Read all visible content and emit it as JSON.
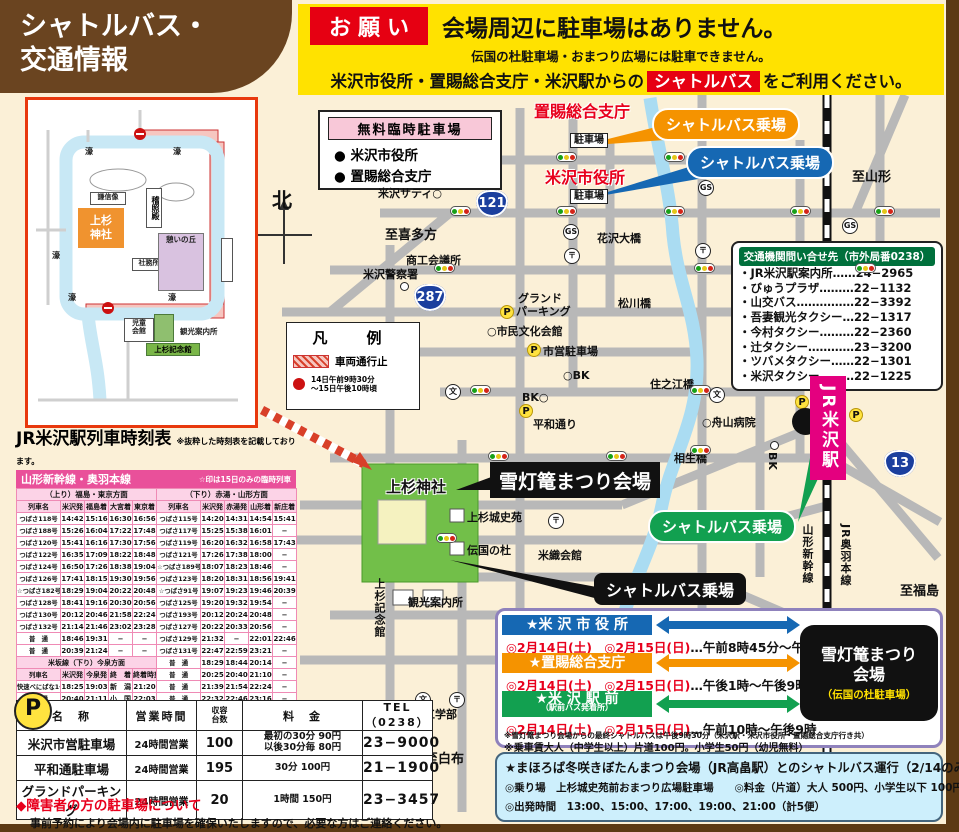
{
  "header": {
    "title_line1": "シャトルバス・",
    "title_line2": "交通情報",
    "request_badge": "お願い",
    "main_notice": "会場周辺に駐車場はありません。",
    "sub_notice": "伝国の杜駐車場・おまつり広場には駐車できません。",
    "line3_pre": "米沢市役所・置賜総合支庁・米沢駅からの",
    "line3_badge": "シャトルバス",
    "line3_post": "をご利用ください。"
  },
  "free_parking_box": {
    "title": "無料臨時駐車場",
    "items": [
      "● 米沢市役所",
      "● 置賜総合支庁"
    ]
  },
  "legend": {
    "title": "凡　例",
    "no_entry_label": "車両通行止",
    "note_line1": "14日午前9時30分",
    "note_line2": "〜15日午後10時頃"
  },
  "compass": "北",
  "inset": {
    "labels": {
      "moat": "濠",
      "shrine": "上杉神社",
      "keisho": "稽照殿",
      "statue": "謙信像",
      "office": "社務所",
      "hill": "憩いの丘",
      "child": "児童会館",
      "memorial": "上杉記念館",
      "info": "観光案内所"
    }
  },
  "map": {
    "bubbles": {
      "orange": "シャトルバス乗場",
      "blue": "シャトルバス乗場",
      "green": "シャトルバス乗場",
      "black": "シャトルバス乗場"
    },
    "venue_callout": "雪灯篭まつり会場",
    "station": "JR米沢駅",
    "badges": [
      {
        "n": "121",
        "x": 476,
        "y": 190
      },
      {
        "n": "287",
        "x": 414,
        "y": 284
      },
      {
        "n": "13",
        "x": 884,
        "y": 450
      }
    ],
    "labels": [
      {
        "t": "置賜総合支庁",
        "x": 534,
        "y": 98,
        "c": "redbig"
      },
      {
        "t": "米沢市役所",
        "x": 545,
        "y": 164,
        "c": "redbig"
      },
      {
        "t": "駐車場",
        "x": 570,
        "y": 133,
        "c": "pbox"
      },
      {
        "t": "駐車場",
        "x": 570,
        "y": 189,
        "c": "pbox"
      },
      {
        "t": "米沢サティ○",
        "x": 378,
        "y": 185,
        "c": "plain"
      },
      {
        "t": "至喜多方",
        "x": 385,
        "y": 224,
        "c": "dir"
      },
      {
        "t": "至山形",
        "x": 852,
        "y": 166,
        "c": "dir"
      },
      {
        "t": "商工会議所",
        "x": 406,
        "y": 252,
        "c": "plain"
      },
      {
        "t": "米沢警察署",
        "x": 363,
        "y": 266,
        "c": "plain"
      },
      {
        "t": "花沢大橋",
        "x": 597,
        "y": 230,
        "c": "plain"
      },
      {
        "t": "松川橋",
        "x": 618,
        "y": 295,
        "c": "plain"
      },
      {
        "t": "グランド",
        "x": 518,
        "y": 290,
        "c": "plain"
      },
      {
        "t": "パーキング",
        "x": 516,
        "y": 303,
        "c": "plain"
      },
      {
        "t": "○市民文化会館",
        "x": 487,
        "y": 323,
        "c": "plain"
      },
      {
        "t": "市営駐車場",
        "x": 543,
        "y": 343,
        "c": "plain"
      },
      {
        "t": "○BK",
        "x": 563,
        "y": 369,
        "c": "plain"
      },
      {
        "t": "BK○",
        "x": 522,
        "y": 391,
        "c": "plain"
      },
      {
        "t": "平和通り",
        "x": 533,
        "y": 416,
        "c": "plain"
      },
      {
        "t": "住之江橋",
        "x": 650,
        "y": 376,
        "c": "plain"
      },
      {
        "t": "○舟山病院",
        "x": 702,
        "y": 414,
        "c": "plain"
      },
      {
        "t": "相生橋",
        "x": 674,
        "y": 450,
        "c": "plain"
      },
      {
        "t": "米織会館",
        "x": 538,
        "y": 547,
        "c": "plain"
      },
      {
        "t": "観光案内所",
        "x": 408,
        "y": 594,
        "c": "plain"
      },
      {
        "t": "山大工学部",
        "x": 402,
        "y": 706,
        "c": "plain"
      },
      {
        "t": "至白布",
        "x": 425,
        "y": 748,
        "c": "dir"
      },
      {
        "t": "至福島",
        "x": 900,
        "y": 580,
        "c": "dir"
      },
      {
        "t": "上杉城史苑",
        "x": 467,
        "y": 509,
        "c": "plain"
      },
      {
        "t": "伝国の杜",
        "x": 467,
        "y": 542,
        "c": "plain"
      },
      {
        "t": "上杉神社",
        "x": 386,
        "y": 476,
        "c": "shrine-l"
      },
      {
        "t": "山形新幹線",
        "x": 799,
        "y": 524,
        "c": "vert"
      },
      {
        "t": "JR奥羽本線",
        "x": 837,
        "y": 524,
        "c": "vert"
      },
      {
        "t": "上杉記念館",
        "x": 371,
        "y": 578,
        "c": "vert"
      },
      {
        "t": "BK",
        "x": 766,
        "y": 452,
        "c": "vert"
      },
      {
        "t": "北",
        "x": 272,
        "y": 184,
        "c": "north-l"
      }
    ],
    "icons": [
      {
        "k": "traffic",
        "x": 556,
        "y": 152
      },
      {
        "k": "traffic",
        "x": 664,
        "y": 152
      },
      {
        "k": "traffic",
        "x": 450,
        "y": 206
      },
      {
        "k": "traffic",
        "x": 556,
        "y": 206
      },
      {
        "k": "traffic",
        "x": 664,
        "y": 206
      },
      {
        "k": "traffic",
        "x": 790,
        "y": 206
      },
      {
        "k": "traffic",
        "x": 874,
        "y": 206
      },
      {
        "k": "traffic",
        "x": 434,
        "y": 263
      },
      {
        "k": "traffic",
        "x": 694,
        "y": 263
      },
      {
        "k": "traffic",
        "x": 855,
        "y": 263
      },
      {
        "k": "traffic",
        "x": 470,
        "y": 385
      },
      {
        "k": "traffic",
        "x": 690,
        "y": 385
      },
      {
        "k": "traffic",
        "x": 488,
        "y": 451
      },
      {
        "k": "traffic",
        "x": 606,
        "y": 451
      },
      {
        "k": "traffic",
        "x": 690,
        "y": 445
      },
      {
        "k": "traffic",
        "x": 436,
        "y": 533
      },
      {
        "k": "traffic",
        "x": 700,
        "y": 533
      },
      {
        "k": "gs",
        "t": "GS",
        "x": 563,
        "y": 224
      },
      {
        "k": "gs",
        "t": "GS",
        "x": 698,
        "y": 180
      },
      {
        "k": "gs",
        "t": "GS",
        "x": 842,
        "y": 218
      },
      {
        "k": "post",
        "t": "〒",
        "x": 564,
        "y": 248
      },
      {
        "k": "post",
        "t": "〒",
        "x": 695,
        "y": 243
      },
      {
        "k": "post",
        "t": "〒",
        "x": 548,
        "y": 513
      },
      {
        "k": "post",
        "t": "〒",
        "x": 449,
        "y": 692
      },
      {
        "k": "school",
        "t": "文",
        "x": 445,
        "y": 384
      },
      {
        "k": "school",
        "t": "文",
        "x": 709,
        "y": 387
      },
      {
        "k": "school",
        "t": "文",
        "x": 415,
        "y": 692
      },
      {
        "k": "circ",
        "x": 400,
        "y": 282
      },
      {
        "k": "circ",
        "x": 770,
        "y": 441
      },
      {
        "k": "p",
        "t": "P",
        "x": 500,
        "y": 305
      },
      {
        "k": "p",
        "t": "P",
        "x": 527,
        "y": 343
      },
      {
        "k": "p",
        "t": "P",
        "x": 519,
        "y": 404
      },
      {
        "k": "p",
        "t": "P",
        "x": 795,
        "y": 395
      },
      {
        "k": "p",
        "t": "P",
        "x": 849,
        "y": 408
      }
    ]
  },
  "contact_box": {
    "title": "交通機関問い合せ先（市外局番0238）",
    "entries": [
      {
        "name": "・JR米沢駅案内所",
        "dots": "……",
        "tel": "24−2965"
      },
      {
        "name": "・びゅうプラザ",
        "dots": "………",
        "tel": "22−1132"
      },
      {
        "name": "・山交バス",
        "dots": "……………",
        "tel": "22−3392"
      },
      {
        "name": "・吾妻観光タクシー",
        "dots": "…",
        "tel": "22−1317"
      },
      {
        "name": "・今村タクシー",
        "dots": "………",
        "tel": "22−2360"
      },
      {
        "name": "・辻タクシー",
        "dots": "…………",
        "tel": "23−3200"
      },
      {
        "name": "・ツバメタクシー",
        "dots": "……",
        "tel": "22−1301"
      },
      {
        "name": "・米沢タクシー",
        "dots": "………",
        "tel": "22−1225"
      }
    ]
  },
  "timetable": {
    "title": "JR米沢駅列車時刻表",
    "title_note": "※抜粋した時刻表を記載しております。",
    "line_name": "山形新幹線・奥羽本線",
    "line_note": "☆印は15日のみの臨時列車",
    "up": {
      "direction": "（上り）福島・東京方面",
      "cols": [
        "列車名",
        "米沢発",
        "福島着",
        "大宮着",
        "東京着"
      ],
      "rows": [
        [
          "つばさ118号",
          "14:42",
          "15:16",
          "16:30",
          "16:56"
        ],
        [
          "つばさ188号",
          "15:26",
          "16:04",
          "17:22",
          "17:48"
        ],
        [
          "つばさ120号",
          "15:41",
          "16:16",
          "17:30",
          "17:56"
        ],
        [
          "つばさ122号",
          "16:35",
          "17:09",
          "18:22",
          "18:48"
        ],
        [
          "つばさ124号",
          "16:50",
          "17:26",
          "18:38",
          "19:04"
        ],
        [
          "つばさ126号",
          "17:41",
          "18:15",
          "19:30",
          "19:56"
        ],
        [
          "☆つばさ182号",
          "18:29",
          "19:04",
          "20:22",
          "20:48"
        ],
        [
          "つばさ128号",
          "18:41",
          "19:16",
          "20:30",
          "20:56"
        ],
        [
          "つばさ130号",
          "20:12",
          "20:46",
          "21:58",
          "22:24"
        ],
        [
          "つばさ132号",
          "21:14",
          "21:46",
          "23:02",
          "23:28"
        ],
        [
          "普　通",
          "18:46",
          "19:31",
          "−",
          "−"
        ],
        [
          "普　通",
          "20:39",
          "21:24",
          "−",
          "−"
        ]
      ]
    },
    "down": {
      "direction": "（下り）赤湯・山形方面",
      "cols": [
        "列車名",
        "米沢発",
        "赤湯発",
        "山形着",
        "新庄着"
      ],
      "rows": [
        [
          "つばさ115号",
          "14:20",
          "14:31",
          "14:54",
          "15:41"
        ],
        [
          "つばさ117号",
          "15:25",
          "15:38",
          "16:01",
          "−"
        ],
        [
          "つばさ119号",
          "16:20",
          "16:32",
          "16:58",
          "17:43"
        ],
        [
          "つばさ121号",
          "17:26",
          "17:38",
          "18:00",
          "−"
        ],
        [
          "☆つばさ189号",
          "18:07",
          "18:23",
          "18:46",
          "−"
        ],
        [
          "つばさ123号",
          "18:20",
          "18:31",
          "18:56",
          "19:41"
        ],
        [
          "☆つばさ91号",
          "19:07",
          "19:23",
          "19:46",
          "20:39"
        ],
        [
          "つばさ125号",
          "19:20",
          "19:32",
          "19:54",
          "−"
        ],
        [
          "つばさ193号",
          "20:12",
          "20:24",
          "20:48",
          "−"
        ],
        [
          "つばさ127号",
          "20:22",
          "20:33",
          "20:56",
          "−"
        ],
        [
          "つばさ129号",
          "21:32",
          "−",
          "22:01",
          "22:46"
        ],
        [
          "つばさ131号",
          "22:47",
          "22:59",
          "23:21",
          "−"
        ],
        [
          "普　通",
          "18:29",
          "18:44",
          "20:14",
          "−"
        ],
        [
          "普　通",
          "20:25",
          "20:40",
          "21:10",
          "−"
        ],
        [
          "普　通",
          "21:39",
          "21:54",
          "22:24",
          "−"
        ],
        [
          "普　通",
          "22:32",
          "22:46",
          "23:16",
          "−"
        ]
      ]
    },
    "yonesaka": {
      "header": "米坂線（下り）今泉方面",
      "cols": [
        "列車名",
        "米沢発",
        "今泉発",
        "終　着",
        "終着時刻"
      ],
      "rows": [
        [
          "快速べにばな1号",
          "18:25",
          "19:03",
          "新　潟",
          "21:20"
        ],
        [
          "普　通",
          "20:40",
          "21:11",
          "小　国",
          "22:03"
        ]
      ]
    }
  },
  "parking_table": {
    "p_badge": "P",
    "cols": [
      "名　称",
      "営業時間",
      "収容\n台数",
      "料　金",
      "TEL（0238）"
    ],
    "rows": [
      [
        "米沢市営駐車場",
        "24時間営業",
        "100",
        "最初の30分 90円\n以後30分毎 80円",
        "23−9000"
      ],
      [
        "平和通駐車場",
        "24時間営業",
        "195",
        "30分 100円",
        "21−1900"
      ],
      [
        "グランドパーキング",
        "24時間営業",
        "20",
        "1時間 150円",
        "23−3457"
      ]
    ]
  },
  "disabled_note": {
    "title": "◆障害者の方の駐車場について",
    "body": "事前予約により会場内に駐車場を確保いたしますので、必要な方はご連絡ください。"
  },
  "shuttle_schedule": {
    "stops": [
      {
        "name": "★米 沢 市 役 所",
        "sub": "",
        "color": "#1668b3",
        "dates": "◎2月14日(土)　◎2月15日(日)",
        "time": "…午前8時45分〜午後9時"
      },
      {
        "name": "★置賜総合支庁",
        "sub": "",
        "color": "#f59300",
        "dates": "◎2月14日(土)　◎2月15日(日)",
        "time": "…午後1時〜午後9時"
      },
      {
        "name": "★米 沢 駅 前",
        "sub": "（駅前バス発着所）",
        "color": "#12a050",
        "dates": "◎2月14日(土)　◎2月15日(日)",
        "time": "…午前10時〜午後9時"
      }
    ],
    "venue_title": "雪灯篭まつり\n会場",
    "venue_sub": "（伝国の杜駐車場）",
    "note1": "※雪灯篭まつり会場からの最終シャトルバスは午後9時30分（米沢駅・米沢市役所・置賜総合支庁行き共）",
    "note2": "※乗車賃大人（中学生以上）片道100円。小学生50円（幼児無料）"
  },
  "mahoroba_box": {
    "title": "★まほろば冬咲きぼたんまつり会場（JR高畠駅）とのシャトルバス運行（2/14のみ）",
    "line1": "◎乗り場　上杉城史苑前おまつり広場駐車場　　◎料金（片道）大人 500円、小学生以下 100円",
    "line2": "◎出発時間　13:00、15:00、17:00、19:00、21:00（計5便）"
  }
}
